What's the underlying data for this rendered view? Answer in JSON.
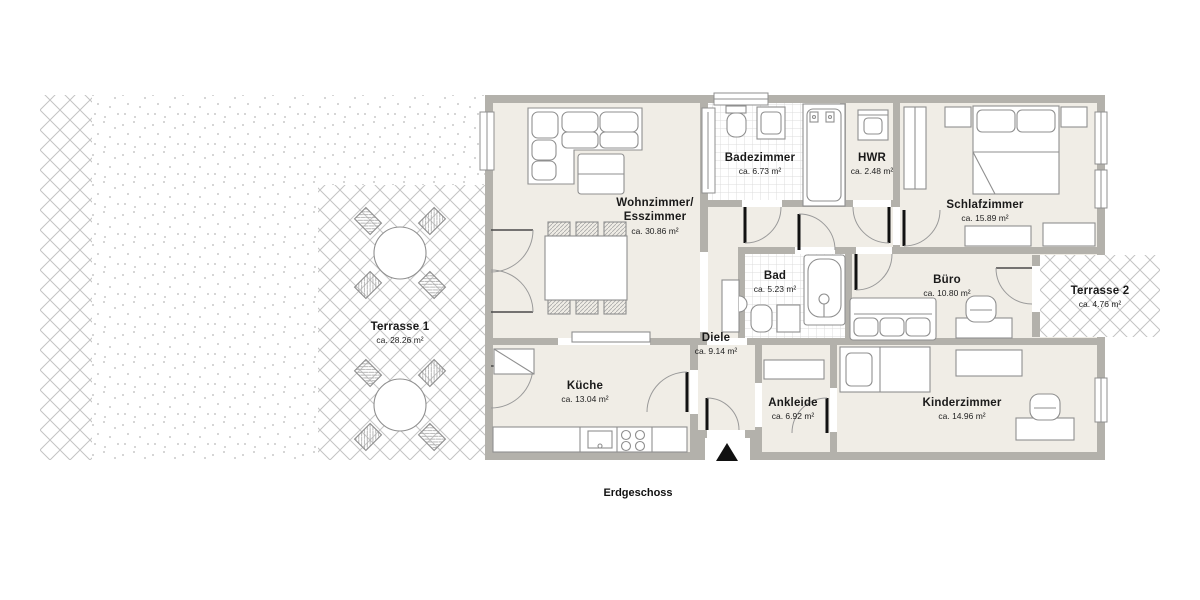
{
  "plan": {
    "floor_label": "Erdgeschoss"
  },
  "rooms": {
    "terrasse1": {
      "name": "Terrasse 1",
      "area": "ca. 28.26 m²"
    },
    "wohnzimmer": {
      "name": "Wohnzimmer/\nEsszimmer",
      "area": "ca. 30.86 m²"
    },
    "badezimmer": {
      "name": "Badezimmer",
      "area": "ca. 6.73 m²"
    },
    "hwr": {
      "name": "HWR",
      "area": "ca. 2.48 m²"
    },
    "schlafzimmer": {
      "name": "Schlafzimmer",
      "area": "ca. 15.89 m²"
    },
    "bad": {
      "name": "Bad",
      "area": "ca. 5.23 m²"
    },
    "buero": {
      "name": "Büro",
      "area": "ca. 10.80 m²"
    },
    "terrasse2": {
      "name": "Terrasse 2",
      "area": "ca. 4.76 m²"
    },
    "diele": {
      "name": "Diele",
      "area": "ca. 9.14 m²"
    },
    "kueche": {
      "name": "Küche",
      "area": "ca. 13.04 m²"
    },
    "ankleide": {
      "name": "Ankleide",
      "area": "ca. 6.92 m²"
    },
    "kinderzimmer": {
      "name": "Kinderzimmer",
      "area": "ca. 14.96 m²"
    }
  },
  "colors": {
    "wall": "#b3b1ab",
    "floor": "#f0ede6",
    "tile_line": "#dcdcdc",
    "hatch_line": "#c3c3c3",
    "furniture_stroke": "#8f8f8f",
    "door_leaf": "#111111",
    "text": "#1a1a1a"
  }
}
